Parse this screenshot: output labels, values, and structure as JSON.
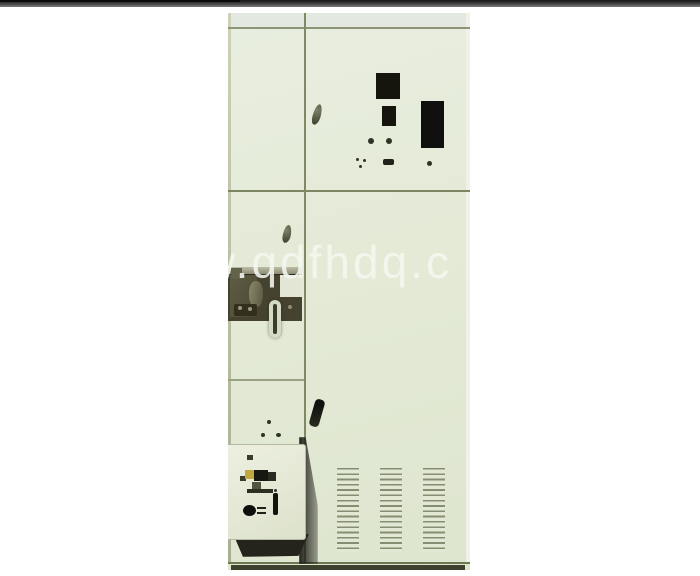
{
  "watermark": {
    "text": "w.qdfhdq.c"
  },
  "photo": {
    "subject": "electrical-switchgear-cabinet",
    "parts": {
      "top_right_panel": "meter-cutout-panel",
      "middle_left_door": "mechanism-opening",
      "bottom_left": "control-box",
      "bottom_right": "ventilation-louvers"
    }
  },
  "colors": {
    "page_background": "#ffffff",
    "top_bar": "#3a3a3a",
    "cabinet_body": "#e4ead6",
    "frame_line": "#7c8761",
    "cutout_black": "#15150e",
    "plinth": "#3e412e",
    "shadow": "#24241c",
    "watermark": "#f4f7f0"
  }
}
